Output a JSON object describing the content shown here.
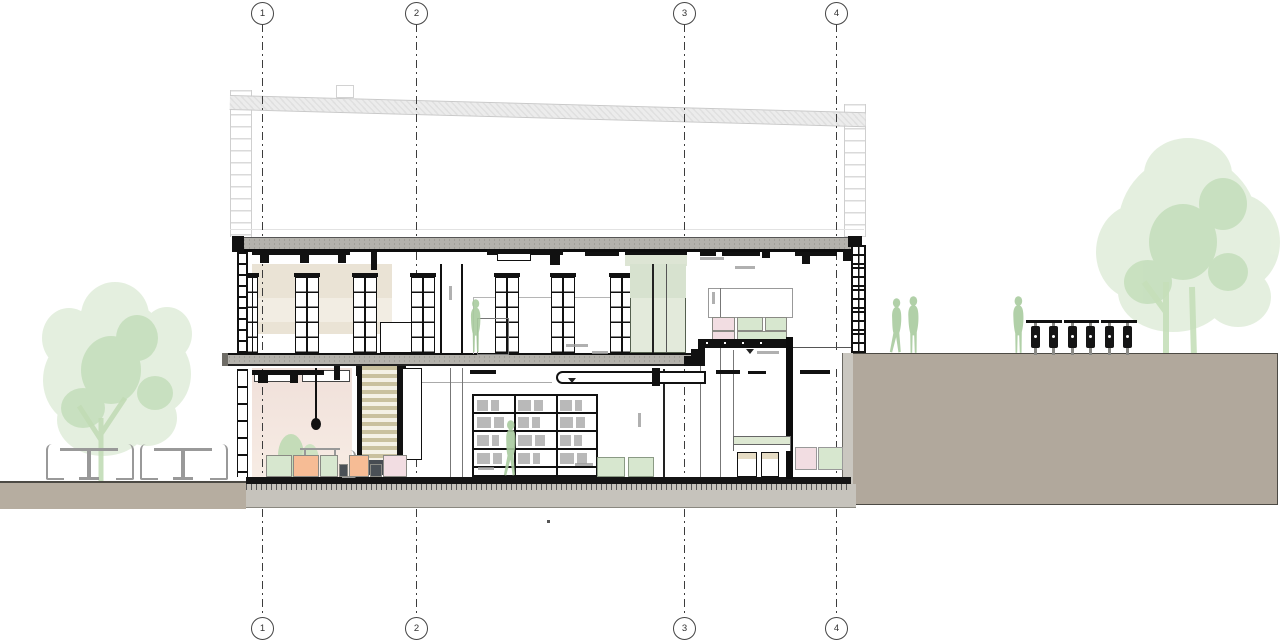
{
  "meta": {
    "drawing_type": "architectural-building-section",
    "sheet_background": "#ffffff"
  },
  "grid": {
    "axes": [
      {
        "label": "1",
        "x": 262
      },
      {
        "label": "2",
        "x": 416
      },
      {
        "label": "3",
        "x": 684
      },
      {
        "label": "4",
        "x": 836
      }
    ]
  },
  "palette": {
    "terrain": "#b1a89c",
    "terrain_left": "#b6ada0",
    "foundation": "#c6c3bc",
    "slab": "#b4b2ac",
    "ghost": "#e8e8e8",
    "tree": "#cfe3c5",
    "tree_dark": "#a9cf9d",
    "person": "#a9cb9f",
    "mint": "#d7e7cf",
    "peach": "#f6bc95",
    "blush": "#f2dde2",
    "slate": "#4a5056",
    "beige_wall": "#eae3d5",
    "pink_room": "#f3e4dd",
    "glass_green": "#e3eadb",
    "stair_tread": "#c9c19f",
    "stool_top": "#e6dcc4"
  },
  "upper_floor": {
    "shelf_towers": [
      {
        "x": 247,
        "w": 11
      },
      {
        "x": 295,
        "w": 24
      },
      {
        "x": 353,
        "w": 24
      },
      {
        "x": 411,
        "w": 24
      },
      {
        "x": 495,
        "w": 24
      },
      {
        "x": 551,
        "w": 24
      },
      {
        "x": 610,
        "w": 24
      }
    ],
    "tiered_seating": {
      "row1": [
        {
          "color": "blush",
          "x": 712,
          "w": 23
        },
        {
          "color": "mint",
          "x": 737,
          "w": 26
        },
        {
          "color": "mint",
          "x": 765,
          "w": 22
        }
      ],
      "row2": [
        {
          "color": "blush",
          "x": 712,
          "w": 23
        },
        {
          "color": "mint",
          "x": 737,
          "w": 50
        }
      ]
    }
  },
  "lower_floor": {
    "seat_blocks": [
      {
        "color": "mint",
        "x": 266,
        "w": 26
      },
      {
        "color": "peach",
        "x": 293,
        "w": 26
      },
      {
        "color": "mint",
        "x": 320,
        "w": 18
      },
      {
        "color": "slate",
        "x": 339,
        "w": 9,
        "low": true
      },
      {
        "color": "peach",
        "x": 349,
        "w": 20
      },
      {
        "color": "slate",
        "x": 370,
        "w": 12,
        "low": true
      },
      {
        "color": "blush",
        "x": 383,
        "w": 24
      }
    ],
    "low_benches": [
      {
        "x": 597,
        "w": 28
      },
      {
        "x": 628,
        "w": 26
      }
    ],
    "bench_cushions": [
      {
        "color": "blush",
        "x": 795,
        "w": 22
      },
      {
        "color": "mint",
        "x": 818,
        "w": 25
      }
    ],
    "bookshelf": {
      "x": 472,
      "y": 394,
      "w": 126,
      "h": 83,
      "shelf_ys": [
        412,
        430,
        448,
        466
      ],
      "divider_xs": [
        514,
        556
      ],
      "book_widths": [
        11,
        8,
        13,
        9,
        12,
        7,
        14,
        10
      ]
    }
  },
  "site": {
    "bike_rack": {
      "bars": [
        {
          "x": 1026,
          "w": 36
        },
        {
          "x": 1064,
          "w": 35
        },
        {
          "x": 1101,
          "w": 36
        }
      ],
      "bike_xs": [
        1031,
        1049,
        1068,
        1086,
        1105,
        1123
      ]
    },
    "people": [
      {
        "pose": "stand",
        "x": 466,
        "y": 299,
        "h": 54,
        "where": "upper-floor"
      },
      {
        "pose": "walk",
        "x": 500,
        "y": 420,
        "h": 57,
        "where": "lower-floor"
      },
      {
        "pose": "walk",
        "x": 886,
        "y": 298,
        "h": 56,
        "where": "site-right"
      },
      {
        "pose": "stand",
        "x": 903,
        "y": 296,
        "h": 58,
        "where": "site-right"
      },
      {
        "pose": "stand",
        "x": 1008,
        "y": 296,
        "h": 58,
        "where": "site-right"
      }
    ],
    "cafe_tables": [
      {
        "x": 58
      },
      {
        "x": 152
      }
    ]
  }
}
